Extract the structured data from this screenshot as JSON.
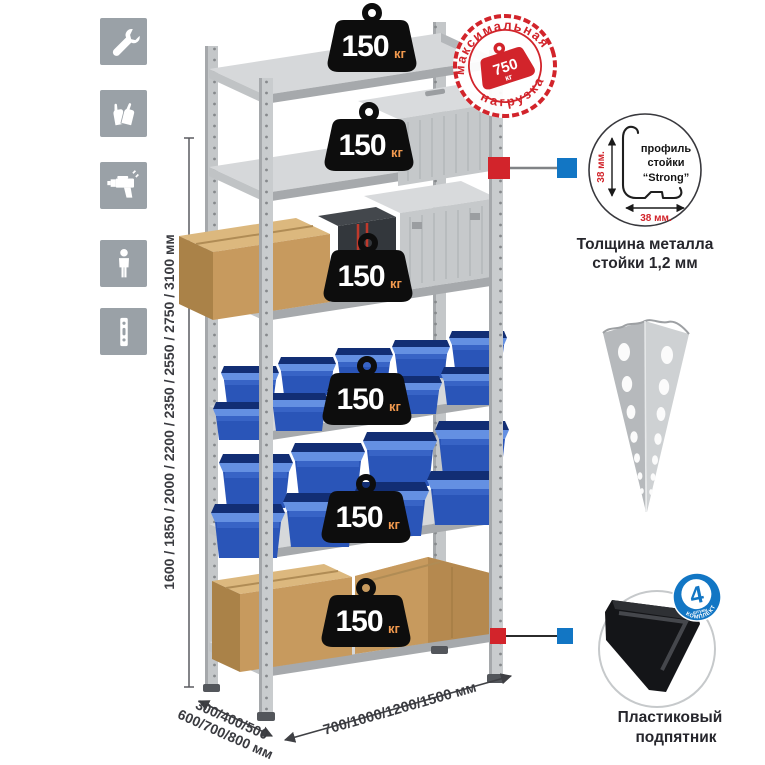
{
  "rack": {
    "heights_label": "1600 / 1850 / 2000 / 2200 / 2350 / 2550 / 2750 / 3100 мм",
    "depth_label_line1": "300/400/500",
    "depth_label_line2": "600/700/800 мм",
    "width_label": "700/1000/1200/1500 мм",
    "shelf_count": 6,
    "load_value": "150",
    "load_unit": "кг"
  },
  "stamp": {
    "arc_top": "максимальная",
    "arc_bottom": "нагрузка",
    "value": "750",
    "unit": "кг"
  },
  "inset": {
    "line1": "профиль",
    "line2": "стойки",
    "line3": "“Strong”",
    "dim_vertical": "38 мм.",
    "dim_horizontal": "38 мм.",
    "caption_line1": "Толщина металла",
    "caption_line2": "стойки 1,2 мм"
  },
  "foot": {
    "caption_line1": "Пластиковый",
    "caption_line2": "подпятник",
    "badge_value": "4",
    "badge_subtext": "штуки",
    "badge_arc_text": "в комплекте"
  },
  "icons": [
    {
      "name": "wrench-icon"
    },
    {
      "name": "gloves-icon"
    },
    {
      "name": "drill-icon"
    },
    {
      "name": "person-icon"
    },
    {
      "name": "rack-profile-icon"
    }
  ],
  "colors": {
    "stamp_red": "#d2242b",
    "marker_blue": "#1276c4",
    "bin_blue": "#2a55b8",
    "cardboard_tan": "#c79a5e",
    "metal_gray": "#c7cacc",
    "icon_gray": "#9aa1a7"
  }
}
